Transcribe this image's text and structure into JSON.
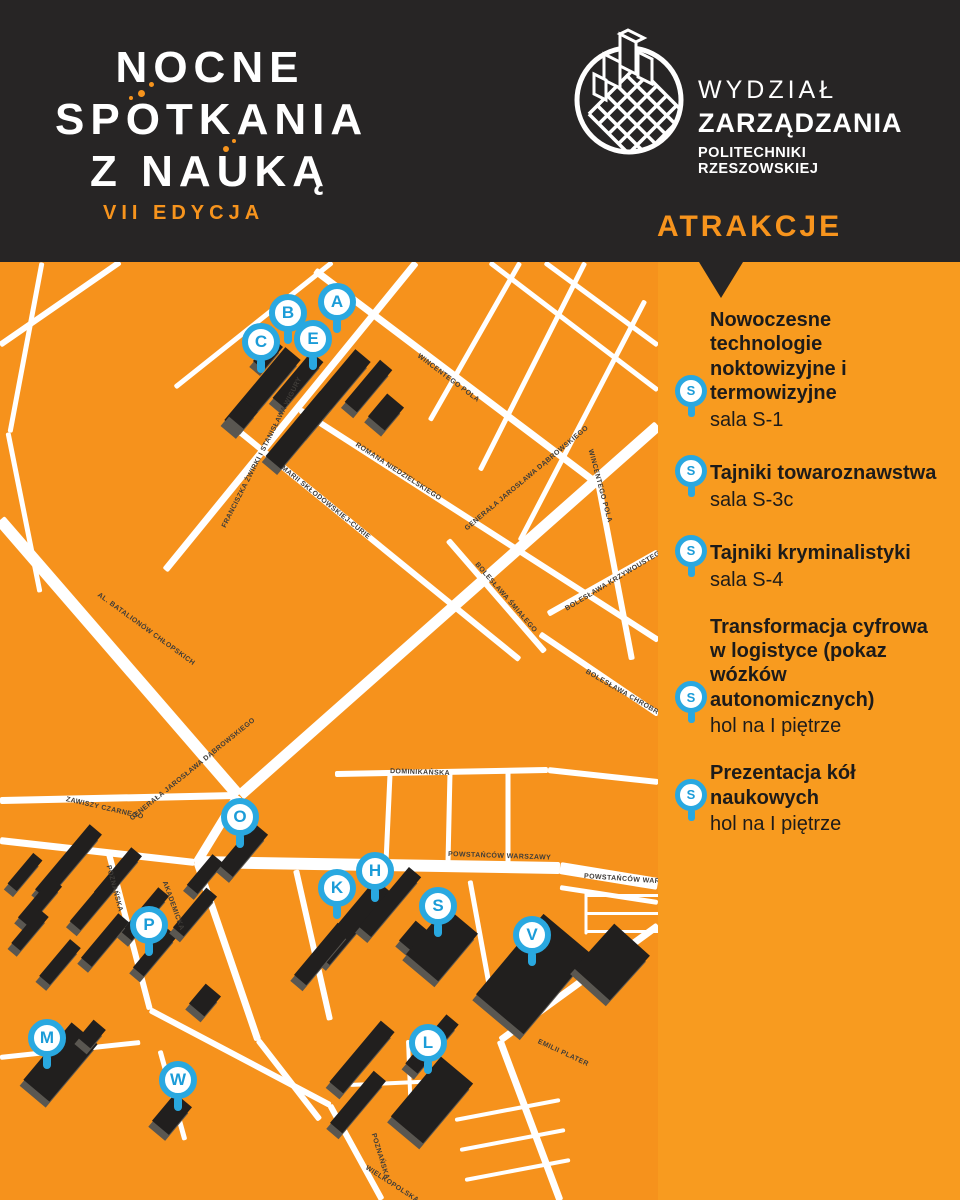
{
  "poster": {
    "event_logo": {
      "line1": "NOCNE",
      "line2": "SPOTKANIA",
      "line3": "Z NAUKĄ",
      "edition": "VII EDYCJA"
    },
    "faculty": {
      "line1": "WYDZIAŁ",
      "line2": "ZARZĄDZANIA",
      "line3": "POLITECHNIKI RZESZOWSKIEJ"
    },
    "attractions_title": "ATRAKCJE"
  },
  "attractions": [
    {
      "pin": "S",
      "title": "Nowoczesne technologie noktowizyjne i termowizyjne",
      "location": "sala S-1"
    },
    {
      "pin": "S",
      "title": "Tajniki towaroznawstwa",
      "location": "sala S-3c"
    },
    {
      "pin": "S",
      "title": "Tajniki kryminalistyki",
      "location": "sala S-4"
    },
    {
      "pin": "S",
      "title": "Transformacja cyfrowa w logistyce (pokaz wózków autonomicznych)",
      "location": "hol na I piętrze"
    },
    {
      "pin": "S",
      "title": "Prezentacja kół naukowych",
      "location": "hol na I piętrze"
    }
  ],
  "map": {
    "pins": [
      {
        "label": "A",
        "x": 337,
        "y": 40
      },
      {
        "label": "B",
        "x": 288,
        "y": 51
      },
      {
        "label": "C",
        "x": 261,
        "y": 80
      },
      {
        "label": "E",
        "x": 313,
        "y": 77
      },
      {
        "label": "O",
        "x": 240,
        "y": 555
      },
      {
        "label": "H",
        "x": 375,
        "y": 609
      },
      {
        "label": "K",
        "x": 337,
        "y": 626
      },
      {
        "label": "S",
        "x": 438,
        "y": 644
      },
      {
        "label": "V",
        "x": 532,
        "y": 673
      },
      {
        "label": "P",
        "x": 149,
        "y": 663
      },
      {
        "label": "M",
        "x": 47,
        "y": 776
      },
      {
        "label": "L",
        "x": 428,
        "y": 781
      },
      {
        "label": "W",
        "x": 178,
        "y": 818
      }
    ],
    "streets": [
      {
        "name": "WINCENTEGO POLA",
        "x": 418,
        "y": 94,
        "rot": 37
      },
      {
        "name": "WINCENTEGO POLA",
        "x": 590,
        "y": 188,
        "rot": 75
      },
      {
        "name": "FRANCISZKA ŻWIRKI I STANISŁAWA WIGURY",
        "x": 224,
        "y": 266,
        "rot": -63
      },
      {
        "name": "MARII SKŁODOWSKIEJ-CURIE",
        "x": 282,
        "y": 206,
        "rot": 39
      },
      {
        "name": "ROMANA NIEDZIELSKIEGO",
        "x": 356,
        "y": 183,
        "rot": 33
      },
      {
        "name": "GENERAŁA JAROSŁAWA DĄBROWSKIEGO",
        "x": 466,
        "y": 268,
        "rot": -40
      },
      {
        "name": "GENERAŁA JAROSŁAWA DĄBROWSKIEGO",
        "x": 131,
        "y": 558,
        "rot": -39
      },
      {
        "name": "AL. BATALIONÓW CHŁOPSKICH",
        "x": 98,
        "y": 333,
        "rot": 36
      },
      {
        "name": "BOLESŁAWA ŚMIAŁEGO",
        "x": 476,
        "y": 302,
        "rot": 49
      },
      {
        "name": "BOLESŁAWA KRZYWOUSTEGO",
        "x": 566,
        "y": 348,
        "rot": -31
      },
      {
        "name": "BOLESŁAWA CHROBREGO",
        "x": 586,
        "y": 410,
        "rot": 30
      },
      {
        "name": "ZAWISZY CZARNEGO",
        "x": 66,
        "y": 538,
        "rot": 13
      },
      {
        "name": "DOMINIKAŃSKA",
        "x": 390,
        "y": 510,
        "rot": 2
      },
      {
        "name": "POWSTAŃCÓW WARSZAWY",
        "x": 448,
        "y": 593,
        "rot": 2
      },
      {
        "name": "POWSTAŃCÓW WARSZAWY",
        "x": 584,
        "y": 615,
        "rot": 4
      },
      {
        "name": "POZNAŃSKA",
        "x": 108,
        "y": 604,
        "rot": 75
      },
      {
        "name": "AKADEMICKA",
        "x": 164,
        "y": 620,
        "rot": 70
      },
      {
        "name": "POZNAŃSKA",
        "x": 373,
        "y": 872,
        "rot": 73
      },
      {
        "name": "WIELKOPOLSKA",
        "x": 366,
        "y": 906,
        "rot": 33
      },
      {
        "name": "EMILII PLATER",
        "x": 538,
        "y": 780,
        "rot": 25
      }
    ]
  },
  "colors": {
    "orange": "#f7941d",
    "header_dark": "#272525",
    "pin_blue": "#29a8e0",
    "building": "#211f1e",
    "road": "#ffffff"
  }
}
